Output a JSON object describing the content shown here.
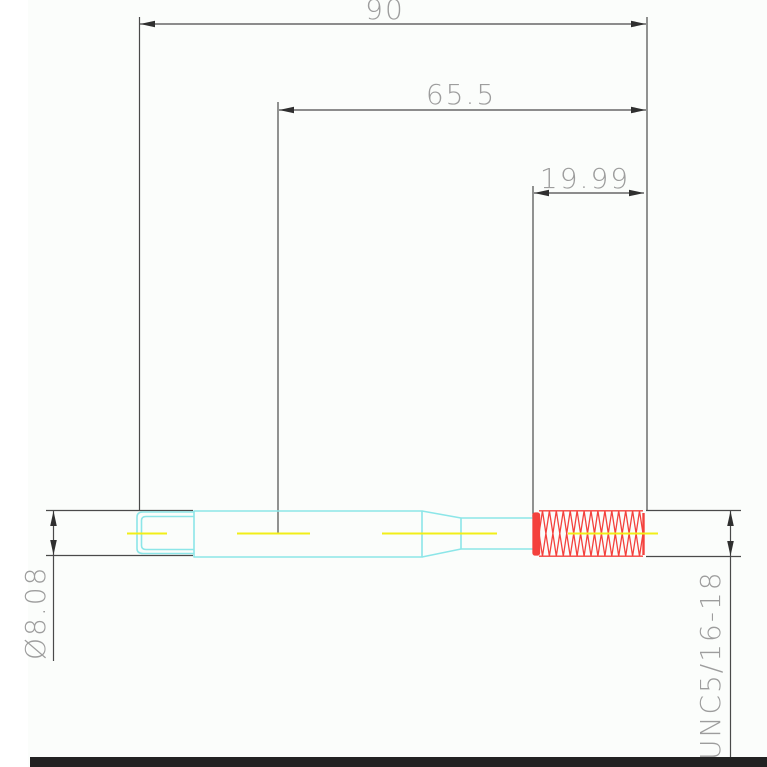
{
  "drawing": {
    "type": "technical-drawing-threaded-stud",
    "dimensions": {
      "overall_length": "90",
      "body_length": "65.5",
      "thread_length": "19.99",
      "diameter": "Ø8.08",
      "thread_spec": "UNC5/16-18"
    },
    "colors": {
      "part_outline": "#8ce6e8",
      "thread": "#f4413d",
      "thread_light": "#f87e7a",
      "centerline": "#f2ee18",
      "dimension_lines": "#4a4a4a",
      "arrowheads": "#2f2f2f",
      "dimension_text": "#9d9d9d",
      "background": "#fbfdfb",
      "bottom_bar": "#222222"
    }
  }
}
